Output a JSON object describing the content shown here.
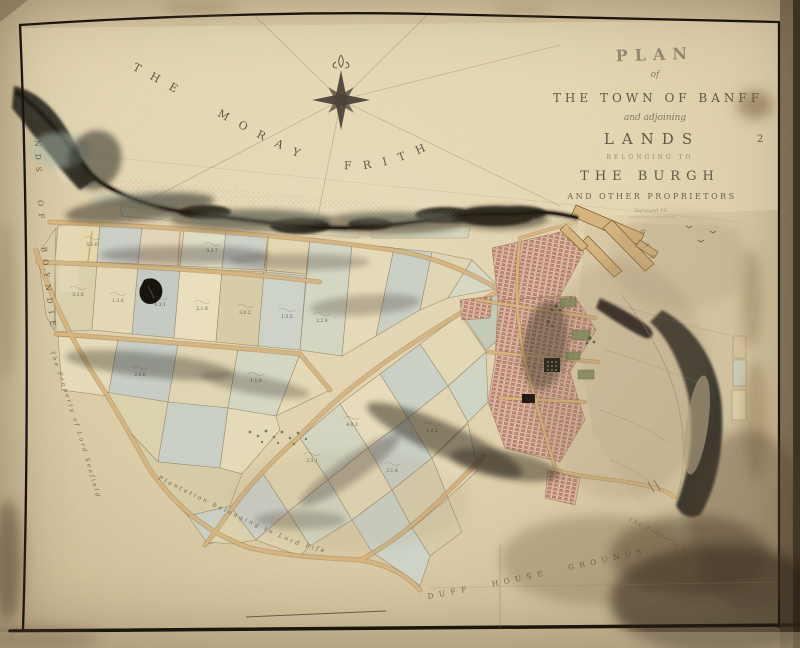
{
  "sheet": {
    "number": "2"
  },
  "title_block": {
    "plan": "PLAN",
    "of": "of",
    "town": "THE TOWN OF BANFF",
    "adjoining": "and adjoining",
    "lands": "LANDS",
    "belonging": "BELONGING TO",
    "burgh": "THE BURGH",
    "proprietors": "AND OTHER PROPRIETORS",
    "imprint": "Surveyed 18.."
  },
  "labels": {
    "sea": "THE MORAY FRITH",
    "left_lands": "LANDS OF BOYNDIE",
    "seafield": "The Property of Lord Seafield",
    "plantation": "Plantation belonging to Lord Fife",
    "duff_grounds": "DUFF HOUSE GROUNDS",
    "bay": "BAY",
    "right_property": "The Property of"
  },
  "field_marks": [
    "3.2.6",
    "1.2.6",
    "4.3.1",
    "2.1.8",
    "3.0.2",
    "1.3.5",
    "2.2.4",
    "5.1.0",
    "3.3.7",
    "2.0.6",
    "1.1.9",
    "4.0.3",
    "2.3.1",
    "3.1.4",
    "1.2.2"
  ]
}
